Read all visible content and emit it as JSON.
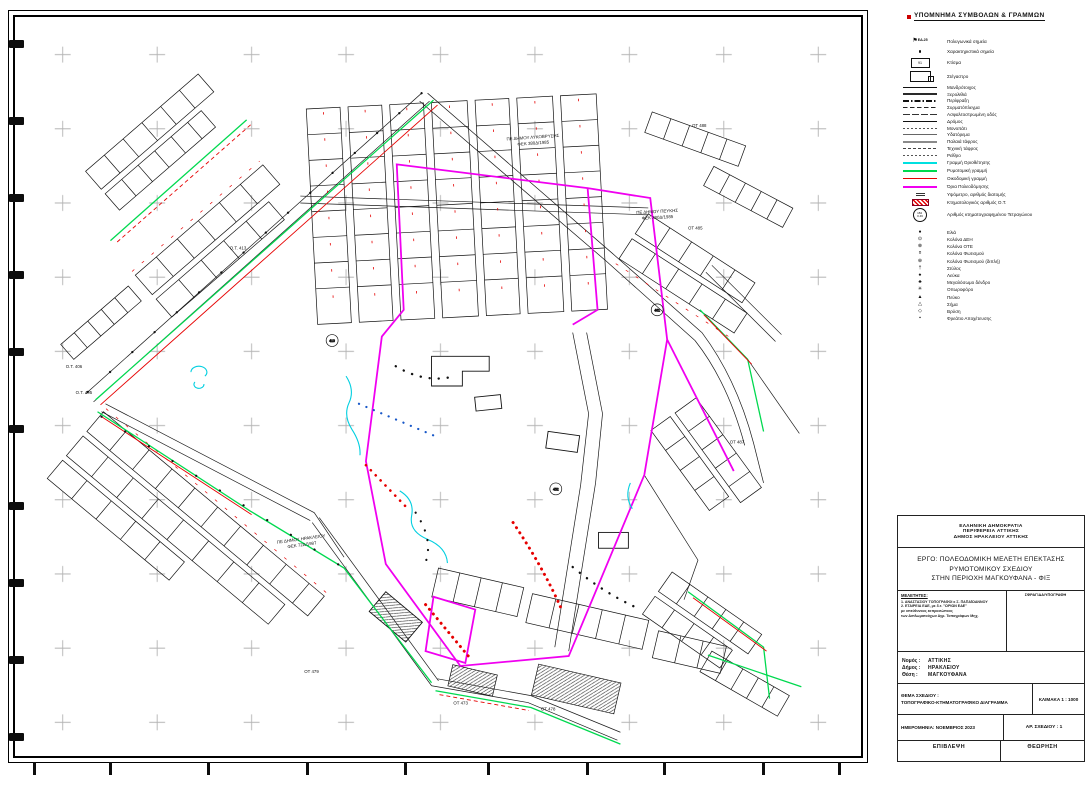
{
  "legend": {
    "heading": "ΥΠΟΜΝΗΜΑ ΣΥΜΒΟΛΩΝ & ΓΡΑΜΜΩΝ",
    "items": [
      {
        "label": "Πολυγωνικά σημεία",
        "symbol_text": "ΕΔ.25"
      },
      {
        "label": "Χαρακτηριστικά σημεία"
      },
      {
        "label": "Κτίσμα",
        "symbol_text": "91"
      },
      {
        "label": "Στέγαστρο"
      },
      {
        "label": "Μανδρότοιχος"
      },
      {
        "label": "Ξερολιθιά"
      },
      {
        "label": "Περίφραξη"
      },
      {
        "label": "Συρματόπλεγμα"
      },
      {
        "label": "Ασφαλτοστρωμένη οδός"
      },
      {
        "label": "Δρόμος"
      },
      {
        "label": "Μονοπάτι"
      },
      {
        "label": "Υδατόρεμα"
      },
      {
        "label": "Παλαιά τάφρος"
      },
      {
        "label": "Τεχνική τάφρος"
      },
      {
        "label": "Ρείθρο"
      },
      {
        "label": "Γραμμή Οριοθέτησης",
        "color": "#00e0e0"
      },
      {
        "label": "Ρυμοτομική γραμμή",
        "color": "#00d94f"
      },
      {
        "label": "Οικοδομική γραμμή",
        "color": "#e60000"
      },
      {
        "label": "Όρια Πολεοδόμησης",
        "color": "#f000f0"
      },
      {
        "label": "Υψόμετρο, αριθμός διατομής"
      },
      {
        "label": "Κτηματολογικός αριθμός Ο.Τ."
      },
      {
        "label": "Αριθμός κτηματογραφημένου Τετραγώνου"
      }
    ],
    "point_items": [
      "Ελιά",
      "Κολόνα ΔΕΗ",
      "Κολόνα ΟΤΕ",
      "Κολόνα Φωτισμού",
      "Κολόνα Φωτισμού (διπλή)",
      "Στύλος",
      "Λεύκα",
      "Μεγαλόσωμο δένδρο",
      "Οπωροφόρο",
      "Πεύκο",
      "Σήμα",
      "Βρύση",
      "Φρεάτιο Αποχέτευσης"
    ]
  },
  "map": {
    "area_labels": [
      {
        "line1": "ΠΕ ΔΗΜΟΥ ΛΥΚΟΒΡΥΣΗΣ",
        "line2": "ΦΕΚ 380Δ/1985"
      },
      {
        "line1": "ΠΕ ΔΗΜΟΥ ΠΕΥΚΗΣ",
        "line2": "ΦΕΚ 380Δ/1985"
      },
      {
        "line1": "ΠΕ ΔΗΜΟΥ ΗΡΑΚΛΕΙΟΥ",
        "line2": "ΦΕΚ 72Δ/1987"
      }
    ],
    "ot_labels": [
      "Ο.Τ. 413",
      "Ο.Τ. 406",
      "Ο.Τ. 405",
      "ΟΤ 485",
      "ΟΤ 487",
      "ΟΤ 488",
      "ΟΤ 479",
      "ΟΤ 478",
      "ΟΤ 473",
      "410",
      "452",
      "461"
    ],
    "colors": {
      "planning_boundary": "#f000f0",
      "alignment_line": "#00d94f",
      "building_line": "#e60000",
      "stream_line": "#00cfe0"
    }
  },
  "title_block": {
    "authority_lines": [
      "ΕΛΛΗΝΙΚΗ ΔΗΜΟΚΡΑΤΙΑ",
      "ΠΕΡΙΦΕΡΕΙΑ ΑΤΤΙΚΗΣ",
      "ΔΗΜΟΣ ΗΡΑΚΛΕΙΟΥ ΑΤΤΙΚΗΣ"
    ],
    "project_lines": [
      "ΕΡΓΟ: ΠΟΛΕΟΔΟΜΙΚΗ ΜΕΛΕΤΗ ΕΠΕΚΤΑΣΗΣ",
      "ΡΥΜΟΤΟΜΙΚΟΥ ΣΧΕΔΙΟΥ",
      "ΣΤΗΝ ΠΕΡΙΟΧΗ ΜΑΓΚΟΥΦΑΝΑ - ΦΙΞ"
    ],
    "designers_heading": "ΜΕΛΕΤΗΤΕΣ:",
    "designers_lines": [
      "1. ΑΝΑΣΤΑΣΙΟΥ ΤΟΠΟΓΡΑΦΟΙ κ Σ. ΠΑΠΑΪΩΑΝΝΟΥ",
      "2. ΕΤΑΙΡΕΙΑ ΕΔΕ, με δ.τ. \"ΩΡΙΩΝ ΕΔΕ\"",
      "με υπεύθυνους εκπροσώπους",
      "των Διπλωματούχων Αγρ. Τοπογράφων Μηχ."
    ],
    "stamp_heading": "ΣΦΡΑΓΙΔΑ/ΥΠΟΓΡΑΦΗ",
    "prefecture_label": "Νομός :",
    "prefecture": "ΑΤΤΙΚΗΣ",
    "municipality_label": "Δήμος :",
    "municipality": "ΗΡΑΚΛΕΙΟΥ",
    "location_label": "Θέση :",
    "location": "ΜΑΓΚΟΥΦΑΝΑ",
    "subject_label": "ΘΕΜΑ ΣΧΕΔΙΟΥ :",
    "subject": "ΤΟΠΟΓΡΑΦΙΚΟ-ΚΤΗΜΑΤΟΓΡΑΦΙΚΟ ΔΙΑΓΡΑΜΜΑ",
    "scale": "ΚΛΙΜΑΚΑ 1 : 1000",
    "date": "ΗΜΕΡΟΜΗΝΙΑ: ΝΟΕΜΒΡΙΟΣ 2023",
    "drawing_no": "ΑΡ. ΣΧΕΔΙΟΥ : 1",
    "supervision": "ΕΠΙΒΛΕΨΗ",
    "approval": "ΘΕΩΡΗΣΗ"
  }
}
